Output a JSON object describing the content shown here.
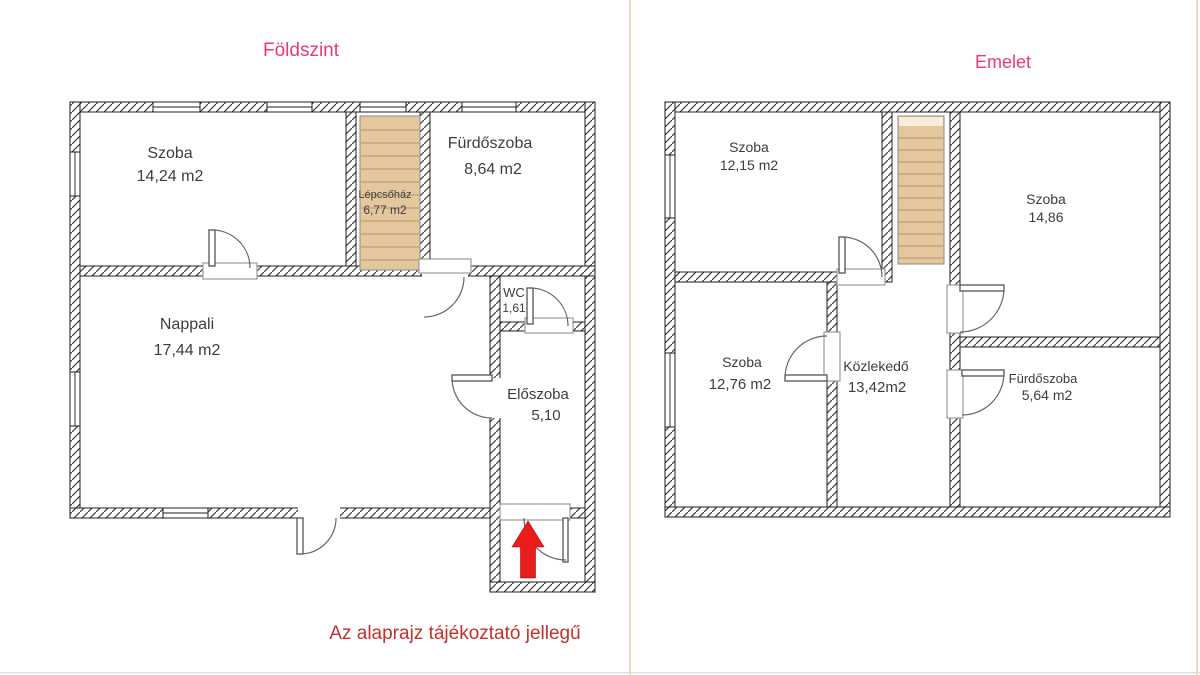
{
  "colors": {
    "title_pink": "#ed3a6d",
    "warning_red": "#c4302b",
    "arrow_red": "#ea1c1c",
    "stair_tan": "#e5c79e",
    "wall_hatch": "#3f3f3f",
    "label_gray": "#3d3d3d",
    "divider_tan": "#e9dcc3"
  },
  "ground": {
    "title": "Földszint",
    "rooms": {
      "szoba": {
        "name": "Szoba",
        "area": "14,24 m2"
      },
      "lepcsohaz": {
        "name": "Lépcsőház",
        "area": "6,77 m2"
      },
      "furdoszoba": {
        "name": "Fürdőszoba",
        "area": "8,64 m2"
      },
      "nappali": {
        "name": "Nappali",
        "area": "17,44 m2"
      },
      "wc": {
        "name": "WC",
        "area": "1,61"
      },
      "eloszoba": {
        "name": "Előszoba",
        "area": "5,10"
      }
    }
  },
  "upper": {
    "title": "Emelet",
    "rooms": {
      "szoba1": {
        "name": "Szoba",
        "area": "12,15 m2"
      },
      "szoba2": {
        "name": "Szoba",
        "area": "14,86"
      },
      "szoba3": {
        "name": "Szoba",
        "area": "12,76 m2"
      },
      "kozlekedo": {
        "name": "Közlekedő",
        "area": "13,42m2"
      },
      "furdoszoba": {
        "name": "Fürdőszoba",
        "area": "5,64 m2"
      }
    }
  },
  "disclaimer": "Az alaprajz tájékoztató jellegű"
}
